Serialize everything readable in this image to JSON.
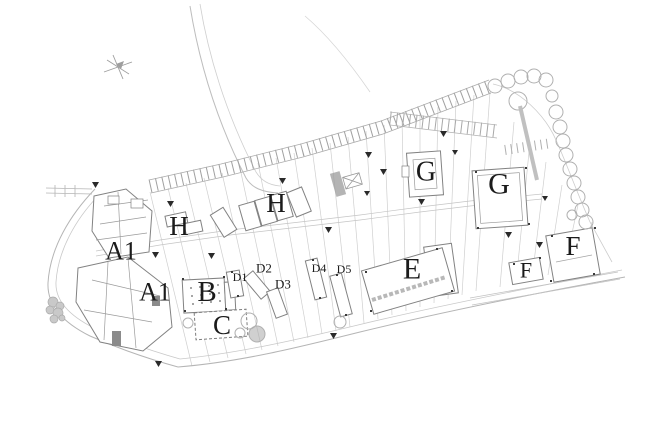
{
  "drawing": {
    "kind": "architectural-site-plan",
    "colors": {
      "paper": "#ffffff",
      "ink": "#1b1b1b",
      "line_dark": "#7d7d7d",
      "line_mid": "#a5a5a5",
      "line_faint": "#cccccc"
    },
    "labels": {
      "a1_upper": "A1",
      "a1_lower": "A1",
      "b": "B",
      "c": "C",
      "d1": "D1",
      "d2": "D2",
      "d3": "D3",
      "d4": "D4",
      "d5": "D5",
      "e": "E",
      "f_left": "F",
      "f_right": "F",
      "g_left": "G",
      "g_right": "G",
      "h_left": "H",
      "h_right": "H"
    }
  }
}
